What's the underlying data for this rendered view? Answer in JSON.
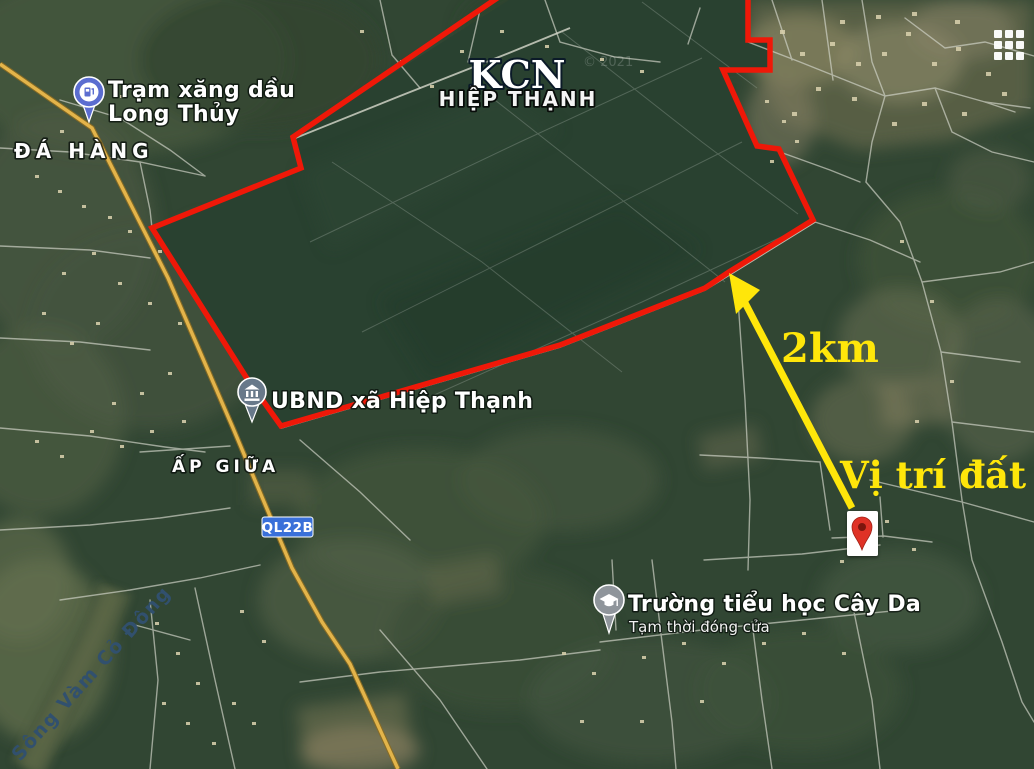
{
  "map": {
    "industrial_zone": {
      "title": "KCN",
      "subtitle": "HIỆP THẠNH"
    },
    "places": {
      "gas_station_line1": "Trạm xăng dầu",
      "gas_station_line2": "Long Thủy",
      "hamlet_da_hang": "ĐÁ HÀNG",
      "hamlet_ap_giua": "ẤP GIỮA",
      "committee": "UBND xã Hiệp Thạnh",
      "school_name": "Trường tiểu học Cây Da",
      "school_status": "Tạm thời đóng cửa",
      "river": "Sông Vàm Cỏ Đông"
    },
    "road_badge": "QL22B",
    "annotations": {
      "distance": "2km",
      "land_position": "Vị trí đất"
    },
    "watermark": "© 2021",
    "icons": {
      "gas_pin": "fuel-pump-icon",
      "committee_pin": "government-building-icon",
      "school_pin": "graduation-cap-icon",
      "land_marker": "red-map-pin-icon",
      "apps": "grid-3x3-icon"
    },
    "colors": {
      "boundary_red": "#ef1808",
      "annotation_yellow": "#ffe60a",
      "badge_blue": "#3a70d9",
      "gas_pin_blue": "#5b6dd0",
      "committee_pin_slate": "#68798a",
      "school_pin_grey": "#8f959b",
      "marker_red": "#df3226",
      "river_label_navy": "#31506e"
    }
  }
}
